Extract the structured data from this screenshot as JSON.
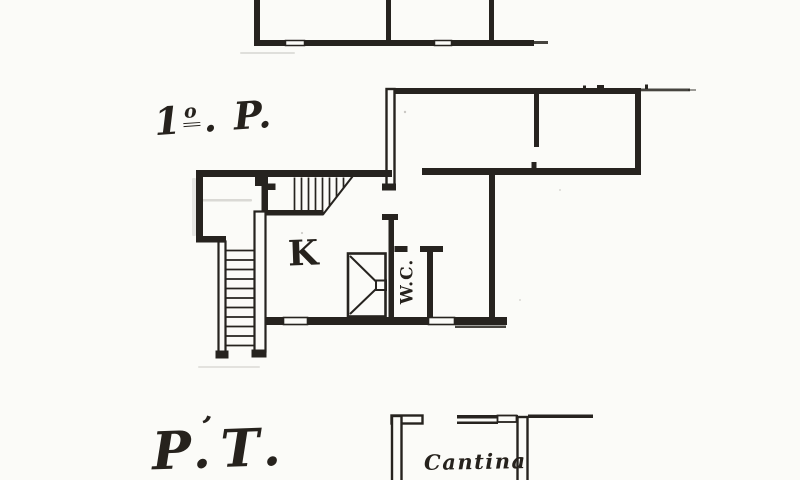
{
  "page": {
    "background": "#fbfbf8",
    "ink": "#26231f",
    "kind": "scanned hand-drawn floor plan"
  },
  "labels": {
    "first_floor": {
      "number": "1",
      "ordinal": "o",
      "suffix": ". P."
    },
    "ground_floor": {
      "text": "P.T.",
      "flourish": "’"
    },
    "kitchen": {
      "text": "K"
    },
    "wc": {
      "text": "W.C."
    },
    "cellar": {
      "text": "Cantina"
    }
  }
}
